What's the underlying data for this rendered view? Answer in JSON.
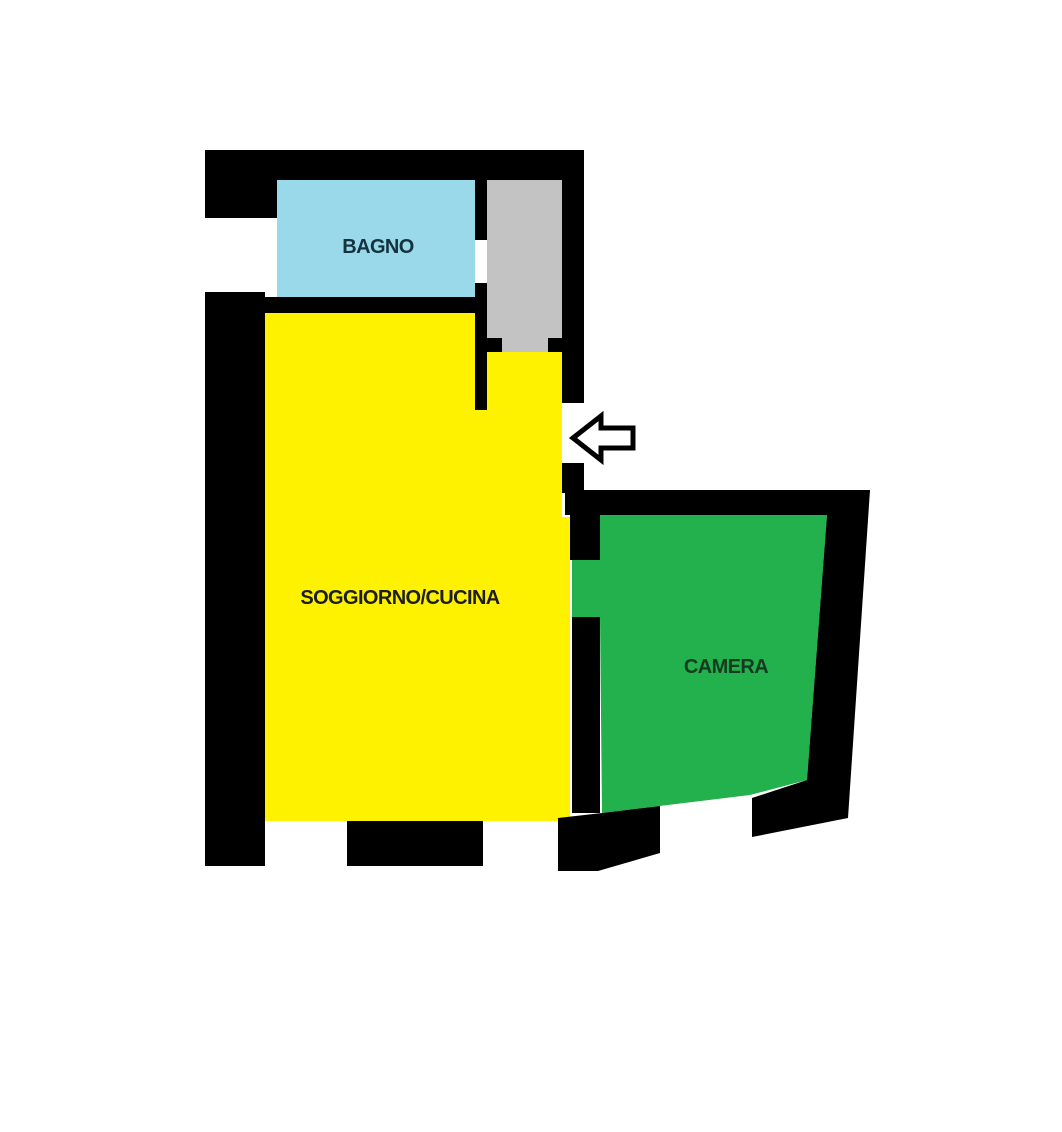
{
  "page": {
    "kind": "apartment-floor-plan",
    "background": "#ffffff"
  },
  "palette": {
    "wall": "#000000",
    "bagno": "#99d9ea",
    "disimpegno": "#c3c3c3",
    "soggiorno_cucina": "#fff200",
    "camera": "#22b14c",
    "arrow_fill": "#ffffff",
    "arrow_stroke": "#000000"
  },
  "typography": {
    "label_font_size": 20
  },
  "rooms": [
    {
      "id": "bagno",
      "label": "BAGNO",
      "fill": "bagno",
      "label_color": "#14333f",
      "label_x": 378,
      "label_y": 253,
      "points": [
        [
          277,
          179
        ],
        [
          475,
          179
        ],
        [
          475,
          297
        ],
        [
          277,
          297
        ]
      ]
    },
    {
      "id": "disimpegno",
      "label": "",
      "fill": "disimpegno",
      "label_color": "#000000",
      "label_x": 0,
      "label_y": 0,
      "points": [
        [
          487,
          180
        ],
        [
          562,
          180
        ],
        [
          562,
          352
        ],
        [
          487,
          352
        ]
      ]
    },
    {
      "id": "soggiorno-cucina",
      "label": "SOGGIORNO/CUCINA",
      "fill": "soggiorno_cucina",
      "label_color": "#1d1d1d",
      "label_x": 400,
      "label_y": 604,
      "points": [
        [
          265,
          313
        ],
        [
          475,
          313
        ],
        [
          475,
          410
        ],
        [
          487,
          410
        ],
        [
          487,
          352
        ],
        [
          562,
          352
        ],
        [
          562,
          517
        ],
        [
          570,
          517
        ],
        [
          570,
          821
        ],
        [
          265,
          821
        ]
      ]
    },
    {
      "id": "camera",
      "label": "CAMERA",
      "fill": "camera",
      "label_color": "#143a1f",
      "label_x": 726,
      "label_y": 673,
      "points": [
        [
          598,
          515
        ],
        [
          827,
          515
        ],
        [
          807,
          780
        ],
        [
          750,
          795
        ],
        [
          602,
          813
        ],
        [
          600,
          617
        ],
        [
          572,
          617
        ],
        [
          572,
          560
        ],
        [
          598,
          560
        ]
      ]
    }
  ],
  "walls": [
    {
      "id": "top-left-block",
      "points": [
        [
          205,
          150
        ],
        [
          277,
          150
        ],
        [
          277,
          218
        ],
        [
          205,
          218
        ]
      ]
    },
    {
      "id": "top-bar",
      "points": [
        [
          205,
          150
        ],
        [
          584,
          150
        ],
        [
          584,
          180
        ],
        [
          205,
          180
        ]
      ]
    },
    {
      "id": "left-column",
      "points": [
        [
          205,
          292
        ],
        [
          265,
          292
        ],
        [
          265,
          866
        ],
        [
          205,
          866
        ]
      ]
    },
    {
      "id": "bagno-south-bar",
      "points": [
        [
          265,
          297
        ],
        [
          487,
          297
        ],
        [
          487,
          313
        ],
        [
          265,
          313
        ]
      ]
    },
    {
      "id": "bagno-hall-divider-upper",
      "points": [
        [
          475,
          179
        ],
        [
          487,
          179
        ],
        [
          487,
          240
        ],
        [
          475,
          240
        ]
      ]
    },
    {
      "id": "bagno-hall-divider-lower",
      "points": [
        [
          475,
          283
        ],
        [
          487,
          283
        ],
        [
          487,
          410
        ],
        [
          475,
          410
        ]
      ]
    },
    {
      "id": "hall-door-stub-left",
      "points": [
        [
          487,
          338
        ],
        [
          502,
          338
        ],
        [
          502,
          352
        ],
        [
          487,
          352
        ]
      ]
    },
    {
      "id": "hall-door-stub-right",
      "points": [
        [
          548,
          338
        ],
        [
          563,
          338
        ],
        [
          563,
          352
        ],
        [
          548,
          352
        ]
      ]
    },
    {
      "id": "right-wall-upper",
      "points": [
        [
          562,
          150
        ],
        [
          584,
          150
        ],
        [
          584,
          403
        ],
        [
          562,
          403
        ]
      ]
    },
    {
      "id": "entry-door-stub",
      "points": [
        [
          562,
          463
        ],
        [
          584,
          463
        ],
        [
          584,
          493
        ],
        [
          562,
          493
        ]
      ]
    },
    {
      "id": "camera-north-bar",
      "points": [
        [
          565,
          490
        ],
        [
          870,
          490
        ],
        [
          866,
          515
        ],
        [
          565,
          515
        ]
      ]
    },
    {
      "id": "soggiorno-camera-divider-upper",
      "points": [
        [
          570,
          513
        ],
        [
          600,
          513
        ],
        [
          600,
          560
        ],
        [
          570,
          560
        ]
      ]
    },
    {
      "id": "soggiorno-camera-divider-lower",
      "points": [
        [
          572,
          617
        ],
        [
          600,
          617
        ],
        [
          600,
          813
        ],
        [
          572,
          813
        ]
      ]
    },
    {
      "id": "camera-east-wall",
      "points": [
        [
          827,
          515
        ],
        [
          870,
          490
        ],
        [
          848,
          818
        ],
        [
          752,
          837
        ],
        [
          752,
          798
        ],
        [
          807,
          780
        ]
      ]
    },
    {
      "id": "camera-south-west-wall",
      "points": [
        [
          558,
          818
        ],
        [
          602,
          813
        ],
        [
          660,
          806
        ],
        [
          660,
          853
        ],
        [
          598,
          871
        ],
        [
          558,
          871
        ]
      ]
    },
    {
      "id": "soggiorno-south-bar",
      "points": [
        [
          347,
          821
        ],
        [
          483,
          821
        ],
        [
          483,
          866
        ],
        [
          347,
          866
        ]
      ]
    }
  ],
  "entrance_arrow": {
    "direction": "left",
    "stroke_width": 5,
    "points": [
      [
        573,
        438
      ],
      [
        601,
        416
      ],
      [
        601,
        428
      ],
      [
        633,
        428
      ],
      [
        633,
        448
      ],
      [
        601,
        448
      ],
      [
        601,
        460
      ]
    ]
  }
}
